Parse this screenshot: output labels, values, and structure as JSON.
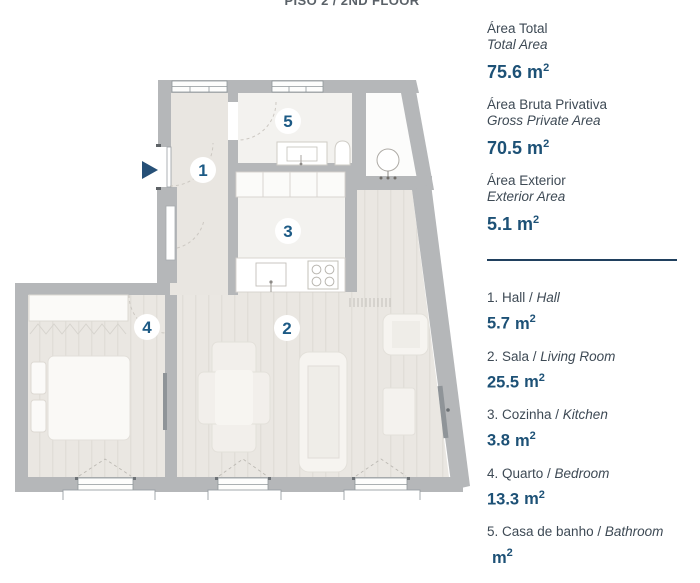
{
  "title": "PISO 2 / 2ND FLOOR",
  "units": {
    "base": "m",
    "sup": "2"
  },
  "panel": {
    "summary": [
      {
        "pt": "Área Total",
        "en": "Total Area",
        "value": "75.6"
      },
      {
        "pt": "Área Bruta Privativa",
        "en": "Gross Private Area",
        "value": "70.5"
      },
      {
        "pt": "Área Exterior",
        "en": "Exterior Area",
        "value": "5.1"
      }
    ],
    "rooms": [
      {
        "pt": "1. Hall / ",
        "en": "Hall",
        "value": "5.7"
      },
      {
        "pt": "2. Sala / ",
        "en": "Living Room",
        "value": "25.5"
      },
      {
        "pt": "3. Cozinha / ",
        "en": "Kitchen",
        "value": "3.8"
      },
      {
        "pt": "4. Quarto / ",
        "en": "Bedroom",
        "value": "13.3"
      },
      {
        "pt": "5. Casa de banho / ",
        "en": "Bathroom",
        "value": ""
      }
    ]
  },
  "plan": {
    "labels": {
      "hall": "1",
      "living": "2",
      "kitchen": "3",
      "bedroom": "4",
      "bathroom": "5"
    }
  },
  "colors": {
    "accent_blue": "#1d5176",
    "text_dark": "#3e4a55",
    "wall_gray": "#b5b7b9",
    "divider_navy": "#20405e"
  }
}
